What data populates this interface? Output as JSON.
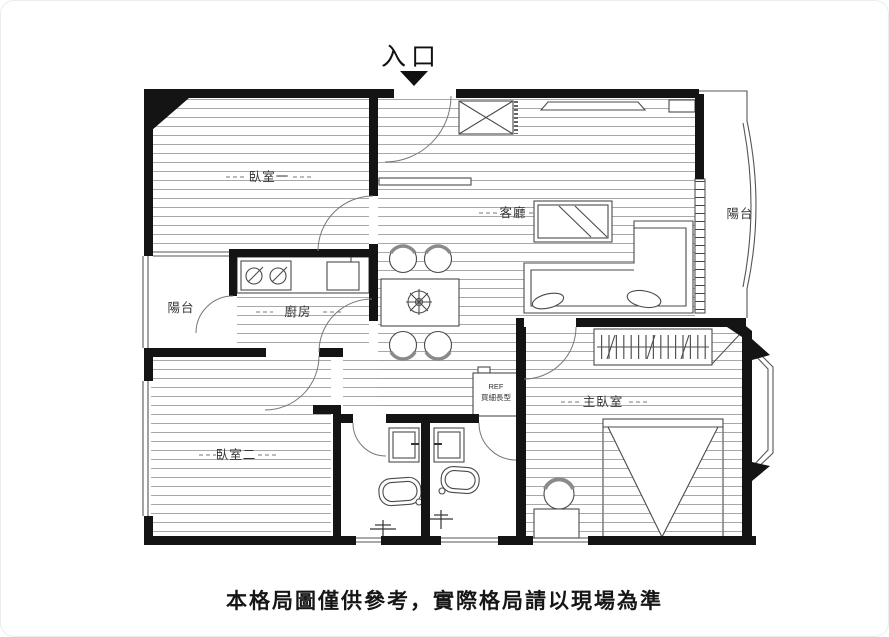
{
  "title": {
    "entrance_label": "入口"
  },
  "rooms": {
    "bedroom1": "臥室一",
    "living_room": "客廳",
    "balcony_right": "陽台",
    "balcony_left": "陽台",
    "kitchen": "廚房",
    "bedroom2": "臥室二",
    "master_bedroom": "主臥室"
  },
  "fixtures": {
    "fridge_code": "REF",
    "fridge_note": "買細長型"
  },
  "caption": {
    "text": "本格局圖僅供參考，實際格局請以現場為準"
  },
  "colors": {
    "wall": "#141414",
    "floor_line": "#9e9e9e",
    "label": "#333333",
    "caption_text": "#161616"
  }
}
